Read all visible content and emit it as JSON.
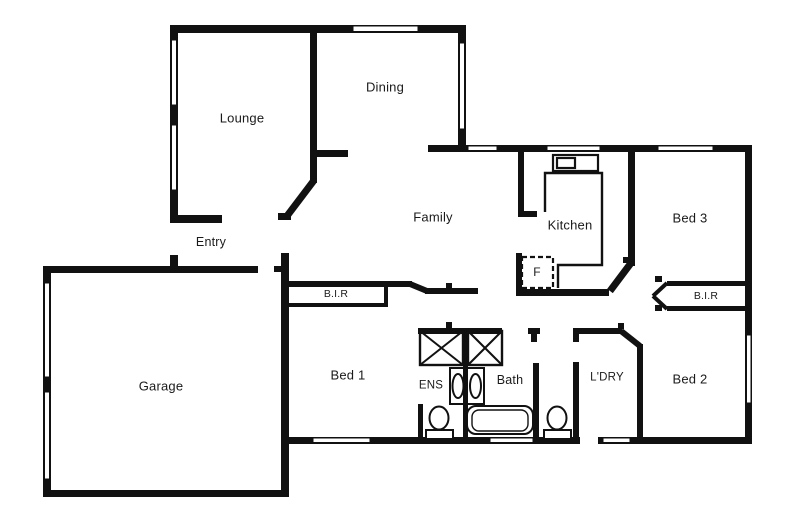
{
  "canvas": {
    "width": 790,
    "height": 527,
    "background": "#ffffff",
    "wall_color": "#111111",
    "label_color": "#1a1a1a"
  },
  "plan_type": "residential floor plan",
  "rooms": [
    {
      "id": "lounge",
      "label": "Lounge",
      "x": 242,
      "y": 118,
      "size": 13
    },
    {
      "id": "dining",
      "label": "Dining",
      "x": 385,
      "y": 87,
      "size": 13
    },
    {
      "id": "family",
      "label": "Family",
      "x": 433,
      "y": 217,
      "size": 13
    },
    {
      "id": "kitchen",
      "label": "Kitchen",
      "x": 570,
      "y": 225,
      "size": 13
    },
    {
      "id": "entry",
      "label": "Entry",
      "x": 211,
      "y": 242,
      "size": 12.5
    },
    {
      "id": "bir-bed1",
      "label": "B.I.R",
      "x": 336,
      "y": 294,
      "size": 10.5
    },
    {
      "id": "fridge",
      "label": "F",
      "x": 537,
      "y": 272,
      "size": 12
    },
    {
      "id": "bed3",
      "label": "Bed 3",
      "x": 690,
      "y": 218,
      "size": 13
    },
    {
      "id": "bir-bed2",
      "label": "B.I.R",
      "x": 706,
      "y": 296,
      "size": 10.5
    },
    {
      "id": "garage",
      "label": "Garage",
      "x": 161,
      "y": 386,
      "size": 13
    },
    {
      "id": "bed1",
      "label": "Bed 1",
      "x": 348,
      "y": 375,
      "size": 13
    },
    {
      "id": "ens",
      "label": "ENS",
      "x": 431,
      "y": 386,
      "size": 11.5
    },
    {
      "id": "bath",
      "label": "Bath",
      "x": 510,
      "y": 380,
      "size": 12.5
    },
    {
      "id": "ldry",
      "label": "L'DRY",
      "x": 607,
      "y": 378,
      "size": 11.5
    },
    {
      "id": "bed2",
      "label": "Bed 2",
      "x": 690,
      "y": 379,
      "size": 13
    }
  ],
  "fixtures": [
    "shower-ens",
    "shower-bath",
    "vanity-ens",
    "vanity-bath",
    "toilet-ens",
    "toilet-wc",
    "bathtub",
    "cooktop-sink",
    "fridge-box"
  ]
}
